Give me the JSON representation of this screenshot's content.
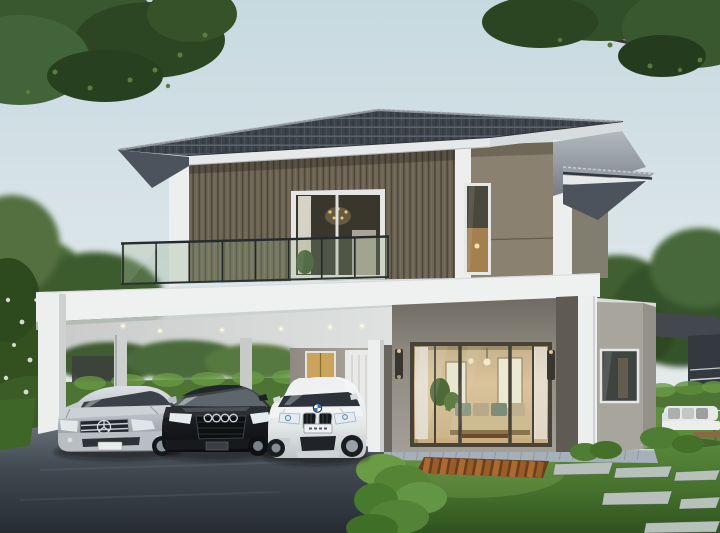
{
  "scene": {
    "alt": "3D architectural rendering of a modern two-storey house with dark grey tiled hip roof, upstairs glass balcony, white carport with three parked cars (silver Mercedes sedan, black Audi, white BMW X6 SUV), large warm-lit sliding glass living-room doors, green lawn with wooden deck strip and stepping stones, hedges and trees, neighbouring houses in background",
    "objects": [
      "house",
      "main-roof",
      "balcony",
      "balcony-door",
      "carport",
      "mercedes-sedan",
      "audi-sedan",
      "bmw-x6",
      "sliding-glass-door",
      "entry-door",
      "lawn",
      "deck",
      "stepping-stones",
      "hedges",
      "driveway",
      "garden-sofa",
      "neighbor-houses",
      "trees"
    ]
  },
  "palette": {
    "canopy": "#3a5830",
    "canopy_dark": "#2c4624",
    "canopy_light": "#567c40",
    "trees_bg": "#4a6a38",
    "roof_tile": "#3d434b",
    "ridge": "#8d949c",
    "fascia": "#e6e9ea",
    "fascia_shade": "#d7dcde",
    "soffit_dark": "#4d535c",
    "wall_smooth": "#8b8171",
    "pillar_white": "#edefee",
    "wing_wall": "#817e6f",
    "wing_wall_ground": "#a8a59d",
    "wing_wall_side": "#94918a",
    "band_white": "#eff1f0",
    "carport_wall": "#a19d95",
    "recess_dark": "#5f5b53",
    "door_white": "#e9eae8",
    "glass_dark": "#3f4440",
    "railing": "#22282b",
    "railing_glass": "rgba(140,170,130,0.28)",
    "hedge": "#4d7434",
    "hedge_bright": "#6a9c45",
    "hedge_dark": "#2f4a20",
    "stone": "#b7c0bb",
    "deck_dark": "#6b3f1e",
    "deck_light": "#aa6a32",
    "neighbor_roof": "#43484f",
    "neighbor_dark": "#34393f",
    "step_tile": "#a6b0ba",
    "sconce": "#38362f",
    "interior_warm": "#d9c49c",
    "car_silver_trim": "#b9bec4",
    "car_black": "#17191d",
    "car_white_trim": "#eef0f1"
  },
  "repeats": {
    "railing_posts": {
      "count": 9,
      "x1": 123,
      "x2": 388,
      "y1": 243.5,
      "y2": 236.5,
      "h": 41
    },
    "downlights": [
      [
        123,
        326
      ],
      [
        160,
        331
      ],
      [
        222,
        330
      ],
      [
        281,
        329
      ],
      [
        330,
        327
      ],
      [
        362,
        326
      ]
    ],
    "stepping_stones": [
      [
        555,
        462,
        58,
        13
      ],
      [
        616,
        466,
        56,
        12
      ],
      [
        676,
        470,
        44,
        11
      ],
      [
        604,
        491,
        68,
        14
      ],
      [
        681,
        497,
        39,
        12
      ],
      [
        646,
        521,
        74,
        12
      ]
    ],
    "deck_slats": {
      "x": 428,
      "y": 458,
      "count": 14,
      "step": 8.7,
      "h": 16
    },
    "step_joints": {
      "from": 392,
      "to": 650,
      "step": 13,
      "y": 447,
      "h": 13
    }
  }
}
